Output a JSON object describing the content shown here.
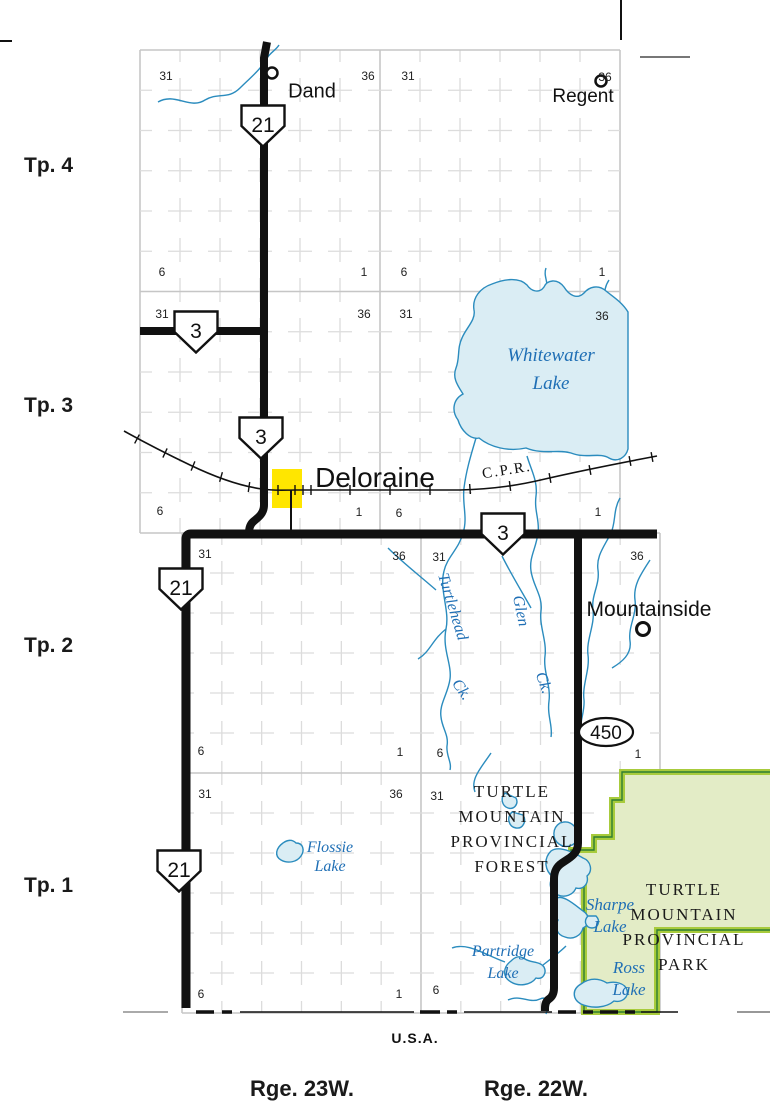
{
  "townships": [
    {
      "label": "Tp. 4",
      "x": 24,
      "y": 165
    },
    {
      "label": "Tp. 3",
      "x": 24,
      "y": 405
    },
    {
      "label": "Tp. 2",
      "x": 24,
      "y": 645
    },
    {
      "label": "Tp. 1",
      "x": 24,
      "y": 885
    }
  ],
  "ranges": [
    {
      "label": "Rge. 23W.",
      "x": 302,
      "y": 1089
    },
    {
      "label": "Rge. 22W.",
      "x": 536,
      "y": 1089
    }
  ],
  "country": "U.S.A.",
  "towns": {
    "dand": "Dand",
    "regent": "Regent",
    "deloraine": "Deloraine",
    "mountainside": "Mountainside"
  },
  "railway": "C.P.R.",
  "water": {
    "whitewater": [
      "Whitewater",
      "Lake"
    ],
    "flossie": [
      "Flossie",
      "Lake"
    ],
    "partridge": [
      "Partridge",
      "Lake"
    ],
    "sharpe": [
      "Sharpe",
      "Lake"
    ],
    "ross": [
      "Ross",
      "Lake"
    ],
    "turtlehead": [
      "Turtlehead",
      "Ck."
    ],
    "glen": [
      "Glen",
      "Ck."
    ]
  },
  "areas": {
    "forest": [
      "TURTLE",
      "MOUNTAIN",
      "PROVINCIAL",
      "FOREST"
    ],
    "park": [
      "TURTLE",
      "MOUNTAIN",
      "PROVINCIAL",
      "PARK"
    ]
  },
  "highways": {
    "shields": [
      {
        "num": "21",
        "x": 263,
        "y": 126
      },
      {
        "num": "3",
        "x": 196,
        "y": 332
      },
      {
        "num": "3",
        "x": 261,
        "y": 438
      },
      {
        "num": "3",
        "x": 503,
        "y": 534
      },
      {
        "num": "21",
        "x": 181,
        "y": 589
      },
      {
        "num": "21",
        "x": 179,
        "y": 871
      }
    ],
    "ovals": [
      {
        "num": "450",
        "x": 577,
        "y": 716
      }
    ]
  },
  "section_numbers": [
    {
      "v": "31",
      "x": 166,
      "y": 76
    },
    {
      "v": "36",
      "x": 368,
      "y": 76
    },
    {
      "v": "31",
      "x": 408,
      "y": 76
    },
    {
      "v": "36",
      "x": 605,
      "y": 77
    },
    {
      "v": "6",
      "x": 162,
      "y": 272
    },
    {
      "v": "1",
      "x": 364,
      "y": 272
    },
    {
      "v": "6",
      "x": 404,
      "y": 272
    },
    {
      "v": "1",
      "x": 602,
      "y": 272
    },
    {
      "v": "31",
      "x": 162,
      "y": 314
    },
    {
      "v": "36",
      "x": 364,
      "y": 314
    },
    {
      "v": "31",
      "x": 406,
      "y": 314
    },
    {
      "v": "36",
      "x": 602,
      "y": 316
    },
    {
      "v": "6",
      "x": 160,
      "y": 511
    },
    {
      "v": "1",
      "x": 359,
      "y": 512
    },
    {
      "v": "6",
      "x": 399,
      "y": 513
    },
    {
      "v": "1",
      "x": 598,
      "y": 512
    },
    {
      "v": "31",
      "x": 205,
      "y": 554
    },
    {
      "v": "36",
      "x": 399,
      "y": 556
    },
    {
      "v": "31",
      "x": 439,
      "y": 557
    },
    {
      "v": "36",
      "x": 637,
      "y": 556
    },
    {
      "v": "6",
      "x": 201,
      "y": 751
    },
    {
      "v": "1",
      "x": 400,
      "y": 752
    },
    {
      "v": "6",
      "x": 440,
      "y": 753
    },
    {
      "v": "1",
      "x": 638,
      "y": 754
    },
    {
      "v": "31",
      "x": 205,
      "y": 794
    },
    {
      "v": "36",
      "x": 396,
      "y": 794
    },
    {
      "v": "31",
      "x": 437,
      "y": 796
    },
    {
      "v": "6",
      "x": 201,
      "y": 994
    },
    {
      "v": "1",
      "x": 399,
      "y": 994
    },
    {
      "v": "6",
      "x": 436,
      "y": 990
    }
  ],
  "colors": {
    "water_fill": "#daedf4",
    "water_line": "#2b8cbe",
    "park_fill": "#e3ecc6",
    "park_band": "#a8cb3c",
    "park_line": "#2e7d32",
    "road": "#111111",
    "highlight": "#ffe600",
    "label_blue": "#1f6fb5"
  }
}
